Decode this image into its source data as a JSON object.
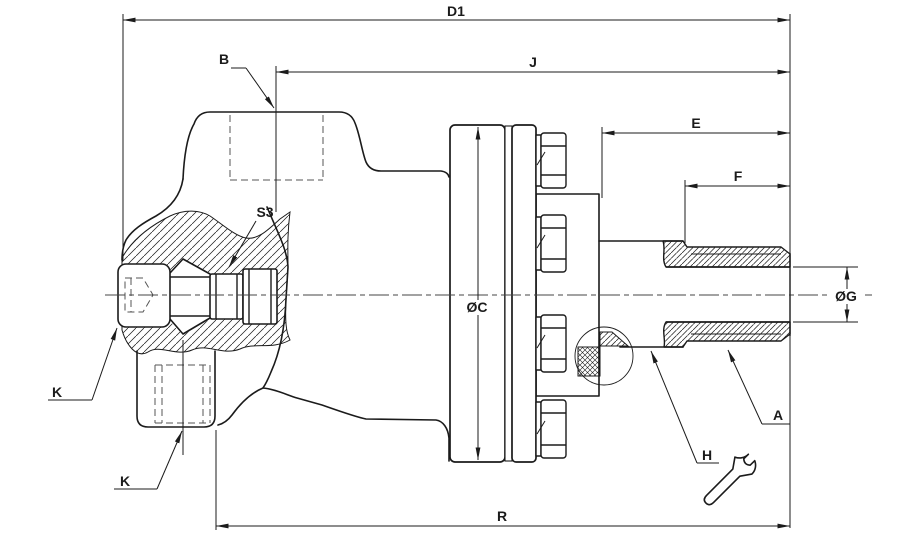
{
  "drawing": {
    "type": "engineering-section-drawing",
    "colors": {
      "line": "#1b1b1b",
      "background": "#ffffff"
    },
    "labels": {
      "d1": "D1",
      "j": "J",
      "b": "B",
      "e": "E",
      "f": "F",
      "dia_g": "ØG",
      "dia_c": "ØC",
      "s3": "S3",
      "k_upper": "K",
      "k_lower": "K",
      "a": "A",
      "h": "H",
      "r": "R"
    },
    "icons": {
      "wrench": "wrench-icon"
    }
  }
}
